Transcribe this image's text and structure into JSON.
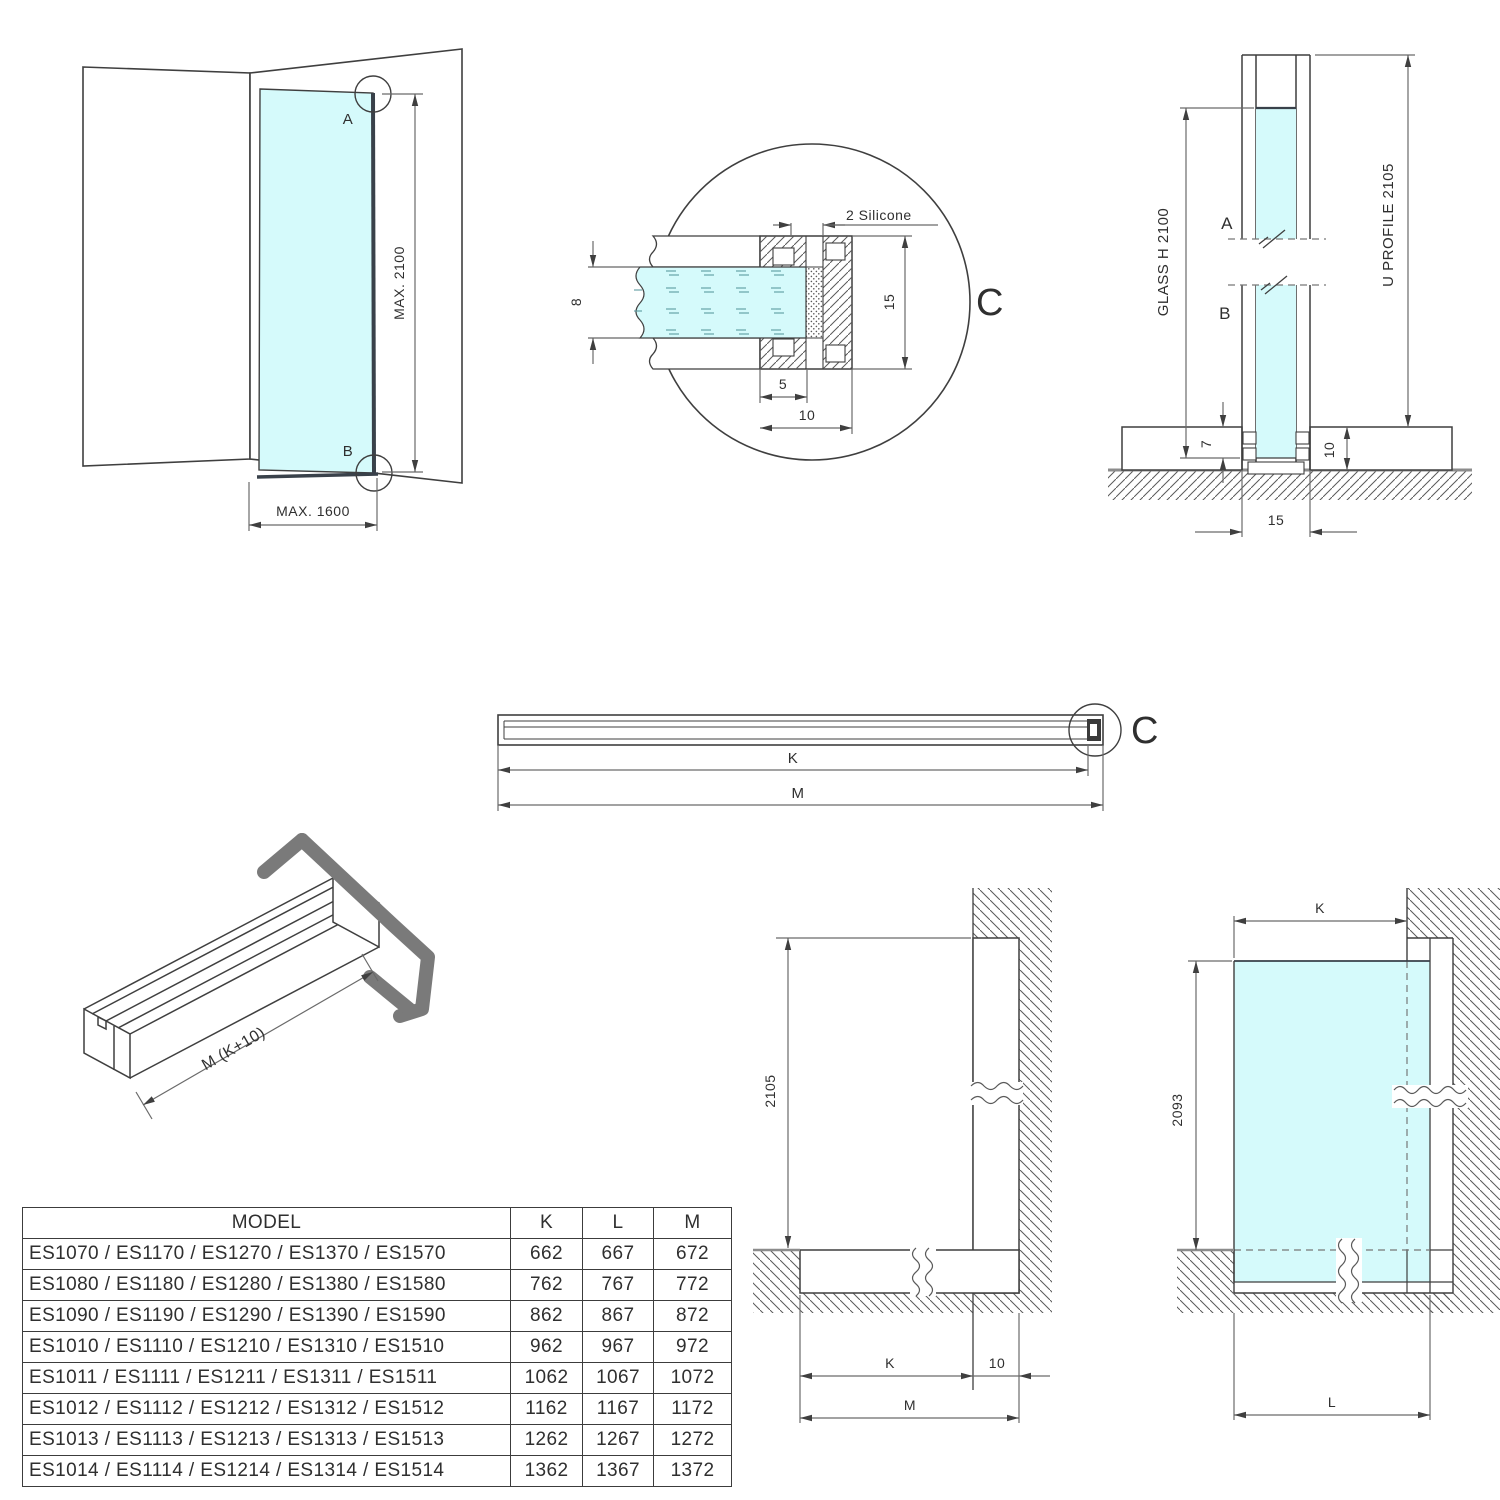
{
  "corner_view": {
    "a": "A",
    "b": "B",
    "max_height": "MAX. 2100",
    "max_width": "MAX. 1600"
  },
  "detail_c": {
    "callout": "2 Silicone",
    "glass_thickness": "8",
    "height": "15",
    "inner_depth": "5",
    "depth": "10",
    "letter": "C"
  },
  "section_view": {
    "a": "A",
    "b": "B",
    "glass": "GLASS H 2100",
    "profile": "U PROFILE 2105",
    "glass_inset": "7",
    "base_height": "10",
    "width": "15"
  },
  "profile_bar": {
    "k": "K",
    "m": "M",
    "letter": "C"
  },
  "profile_3d": {
    "length": "M (K+10)"
  },
  "wall_elevation": {
    "height": "2105",
    "k": "K",
    "offset": "10",
    "m": "M"
  },
  "glass_elevation": {
    "k": "K",
    "height": "2093",
    "l": "L"
  },
  "table": {
    "headers": [
      "MODEL",
      "K",
      "L",
      "M"
    ],
    "rows": [
      {
        "model": "ES1070 / ES1170 / ES1270 / ES1370 / ES1570",
        "k": "662",
        "l": "667",
        "m": "672"
      },
      {
        "model": "ES1080 / ES1180 / ES1280 / ES1380 / ES1580",
        "k": "762",
        "l": "767",
        "m": "772"
      },
      {
        "model": "ES1090 / ES1190 / ES1290 / ES1390 / ES1590",
        "k": "862",
        "l": "867",
        "m": "872"
      },
      {
        "model": "ES1010 / ES1110 / ES1210 / ES1310 / ES1510",
        "k": "962",
        "l": "967",
        "m": "972"
      },
      {
        "model": "ES1011 / ES1111 / ES1211 / ES1311 / ES1511",
        "k": "1062",
        "l": "1067",
        "m": "1072"
      },
      {
        "model": "ES1012 / ES1112 / ES1212 / ES1312 / ES1512",
        "k": "1162",
        "l": "1167",
        "m": "1172"
      },
      {
        "model": "ES1013 / ES1113 / ES1213 / ES1313 / ES1513",
        "k": "1262",
        "l": "1267",
        "m": "1272"
      },
      {
        "model": "ES1014 / ES1114 / ES1214 / ES1314 / ES1514",
        "k": "1362",
        "l": "1367",
        "m": "1372"
      }
    ]
  },
  "colors": {
    "glass": "#d5fafb",
    "line": "#3f3f3f",
    "dim_line": "#6a6a6a",
    "hatch": "#5a5a5a",
    "profile_gray": "#7a7a7a",
    "floor_line": "#8c8c8c"
  }
}
